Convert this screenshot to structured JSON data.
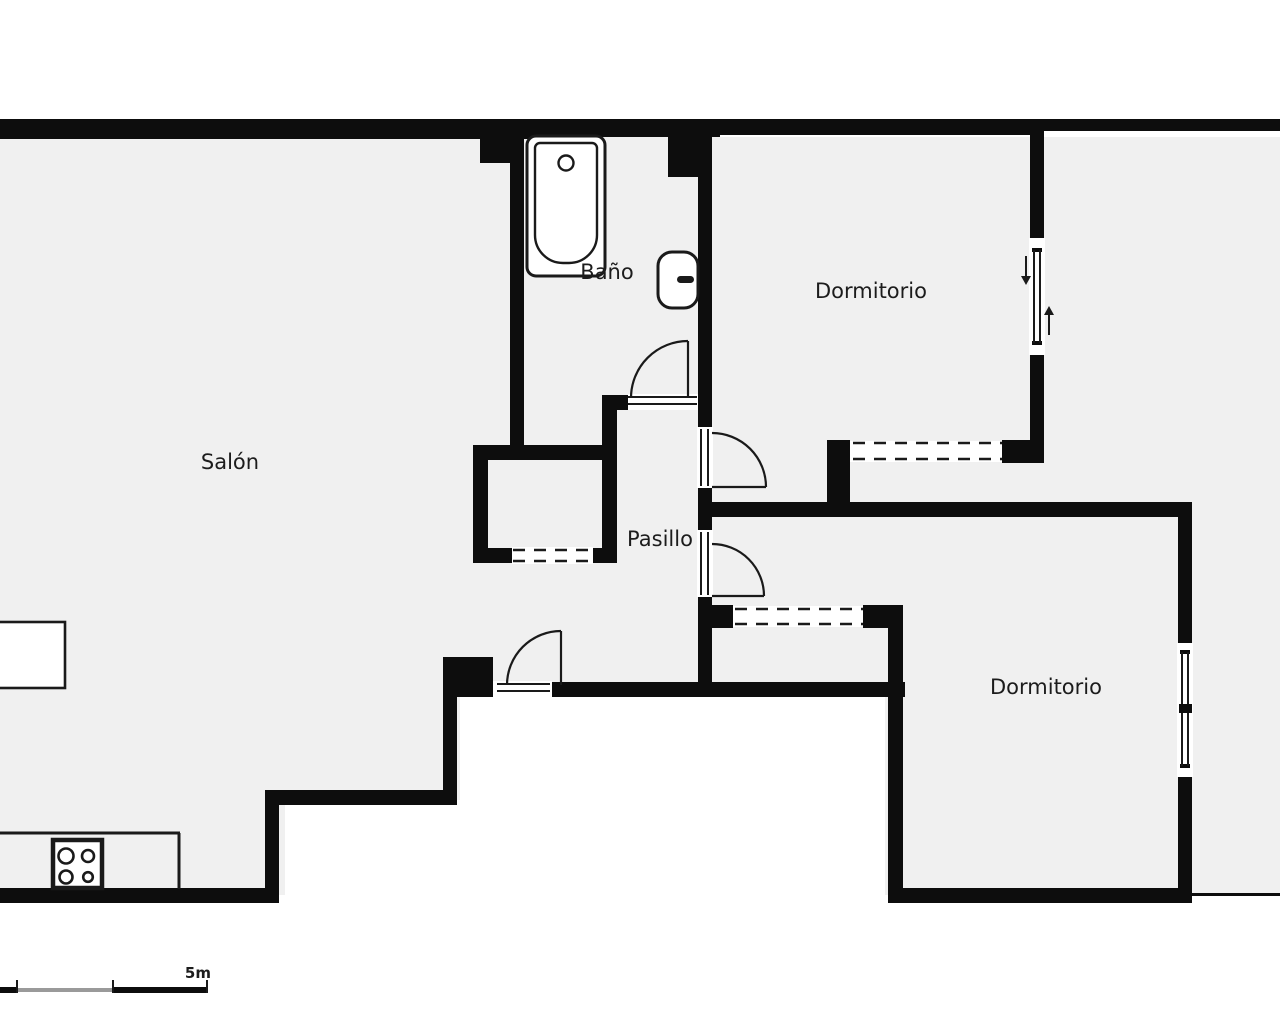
{
  "title": "Apartment floor plan",
  "colors": {
    "wall": "#0d0d0d",
    "floor": "#f0f0f0",
    "outside": "#ffffff",
    "line": "#1a1a1a",
    "scale-gray": "#9a9a9a",
    "text": "#1c1c1c"
  },
  "rooms": {
    "salon": {
      "label": "Salón"
    },
    "bano": {
      "label": "Baño"
    },
    "pasillo": {
      "label": "Pasillo"
    },
    "dormitorio_top": {
      "label": "Dormitorio"
    },
    "dormitorio_bottom": {
      "label": "Dormitorio"
    }
  },
  "fixtures": {
    "bathtub": "bathtub",
    "toilet": "toilet",
    "stove": "stove with 4 burners",
    "kitchen_counter": "kitchen counter",
    "table": "table",
    "wardrobe_dashed_openings": 3,
    "windows": 2,
    "doors": 4,
    "window_swing_arrows": [
      "down",
      "up"
    ]
  },
  "scale_bar": {
    "label": "5m"
  }
}
